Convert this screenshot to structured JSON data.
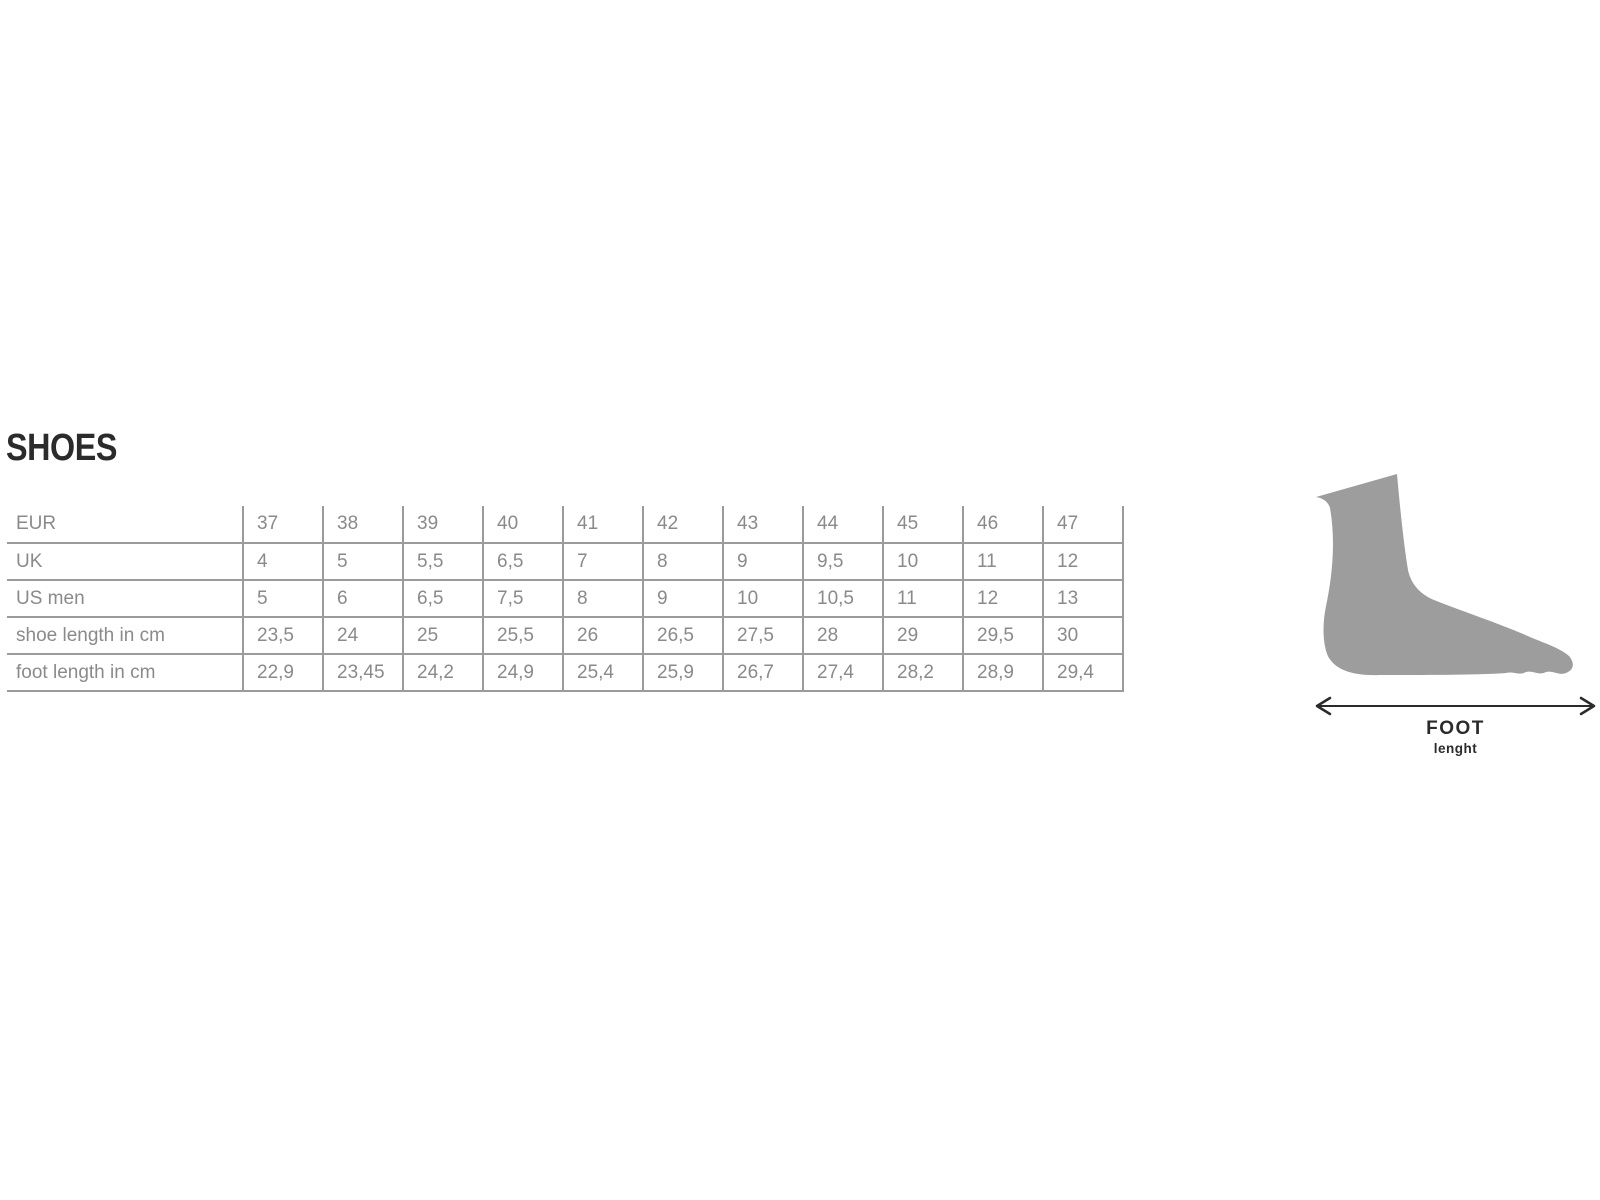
{
  "title": "SHOES",
  "chart_data": {
    "type": "table",
    "title": "SHOES",
    "rows": [
      {
        "label": "EUR",
        "values": [
          "37",
          "38",
          "39",
          "40",
          "41",
          "42",
          "43",
          "44",
          "45",
          "46",
          "47"
        ]
      },
      {
        "label": "UK",
        "values": [
          "4",
          "5",
          "5,5",
          "6,5",
          "7",
          "8",
          "9",
          "9,5",
          "10",
          "11",
          "12"
        ]
      },
      {
        "label": "US men",
        "values": [
          "5",
          "6",
          "6,5",
          "7,5",
          "8",
          "9",
          "10",
          "10,5",
          "11",
          "12",
          "13"
        ]
      },
      {
        "label": "shoe length in cm",
        "values": [
          "23,5",
          "24",
          "25",
          "25,5",
          "26",
          "26,5",
          "27,5",
          "28",
          "29",
          "29,5",
          "30"
        ]
      },
      {
        "label": "foot length in cm",
        "values": [
          "22,9",
          "23,45",
          "24,2",
          "24,9",
          "25,4",
          "25,9",
          "26,7",
          "27,4",
          "28,2",
          "28,9",
          "29,4"
        ]
      }
    ],
    "layout": {
      "grid": "on",
      "first_row_top_border": "none",
      "label_column_left_border": "none"
    }
  },
  "foot_diagram": {
    "label_primary": "FOOT",
    "label_secondary": "lenght"
  },
  "colors": {
    "background": "#ffffff",
    "title_text": "#2b2b2b",
    "table_text": "#8a8a8a",
    "grid_line": "#9b9b9b",
    "foot_fill": "#9d9d9d",
    "arrow": "#2b2b2b"
  }
}
